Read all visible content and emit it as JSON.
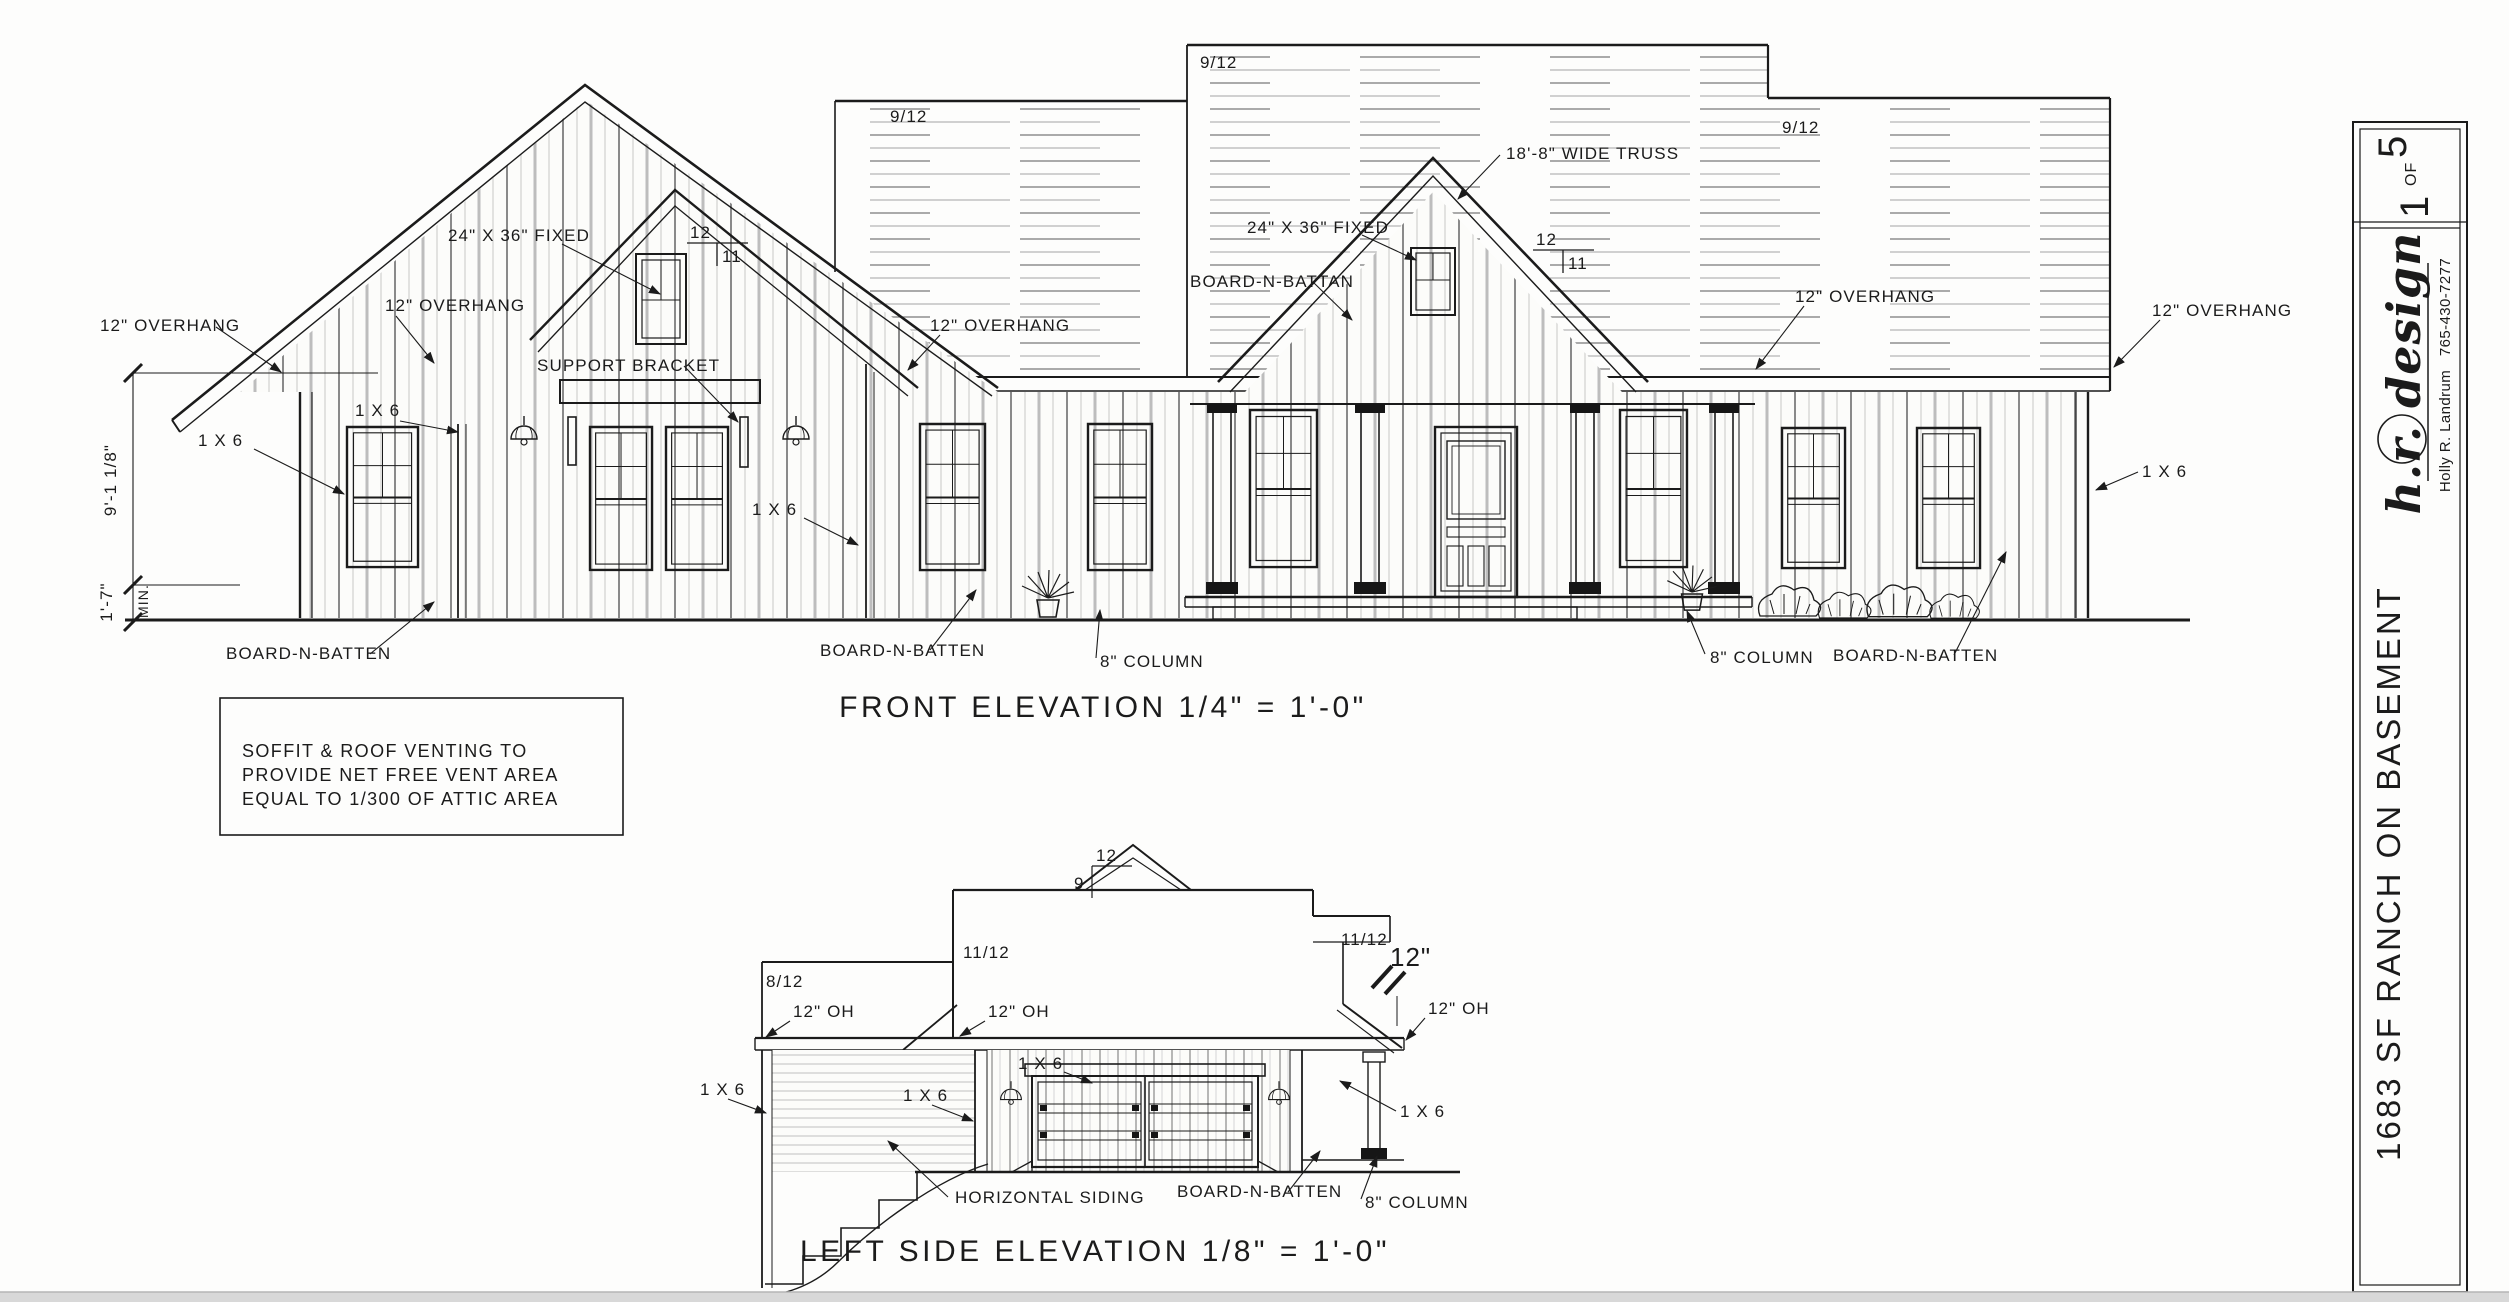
{
  "labels": {
    "pitch_9_12": "9/12",
    "pitch_11_12": "11/12",
    "pitch_8_12": "8/12",
    "front_run": "12",
    "front_rise": "11",
    "side_run": "12",
    "side_rise": "9",
    "overhang": "12\" OVERHANG",
    "oh": "12\" OH",
    "twelve_in": "12\"",
    "one_x_six": "1 X 6",
    "board_n_batten": "BOARD-N-BATTEN",
    "board_n_battan": "BOARD-N-BATTAN",
    "column_8": "8\" COLUMN",
    "truss": "18'-8\" WIDE TRUSS",
    "fixed_window": "24\" X 36\" FIXED",
    "support_bracket": "SUPPORT BRACKET",
    "horizontal_siding": "HORIZONTAL SIDING",
    "dim_height": "9'-1 1/8\"",
    "dim_min_value": "1'-7\"",
    "dim_min_suffix": "MIN."
  },
  "front_elevation": {
    "title": "FRONT ELEVATION 1/4\" = 1'-0\""
  },
  "left_elevation": {
    "title": "LEFT SIDE  ELEVATION 1/8\" = 1'-0\""
  },
  "note": {
    "line1": "SOFFIT & ROOF VENTING TO",
    "line2": "PROVIDE NET FREE VENT AREA",
    "line3": "EQUAL TO 1/300 OF ATTIC AREA"
  },
  "title_block": {
    "sheet_number": "1",
    "of_label": "OF",
    "sheet_total": "5",
    "firm": "h.r. design",
    "designer": "Holly R. Landrum",
    "phone": "765-430-7277",
    "project": "1683 SF RANCH ON BASEMENT"
  },
  "colors": {
    "ink": "#1b1b1b",
    "paper": "#fdfdfc",
    "window_bar": "#d8d8d8"
  }
}
